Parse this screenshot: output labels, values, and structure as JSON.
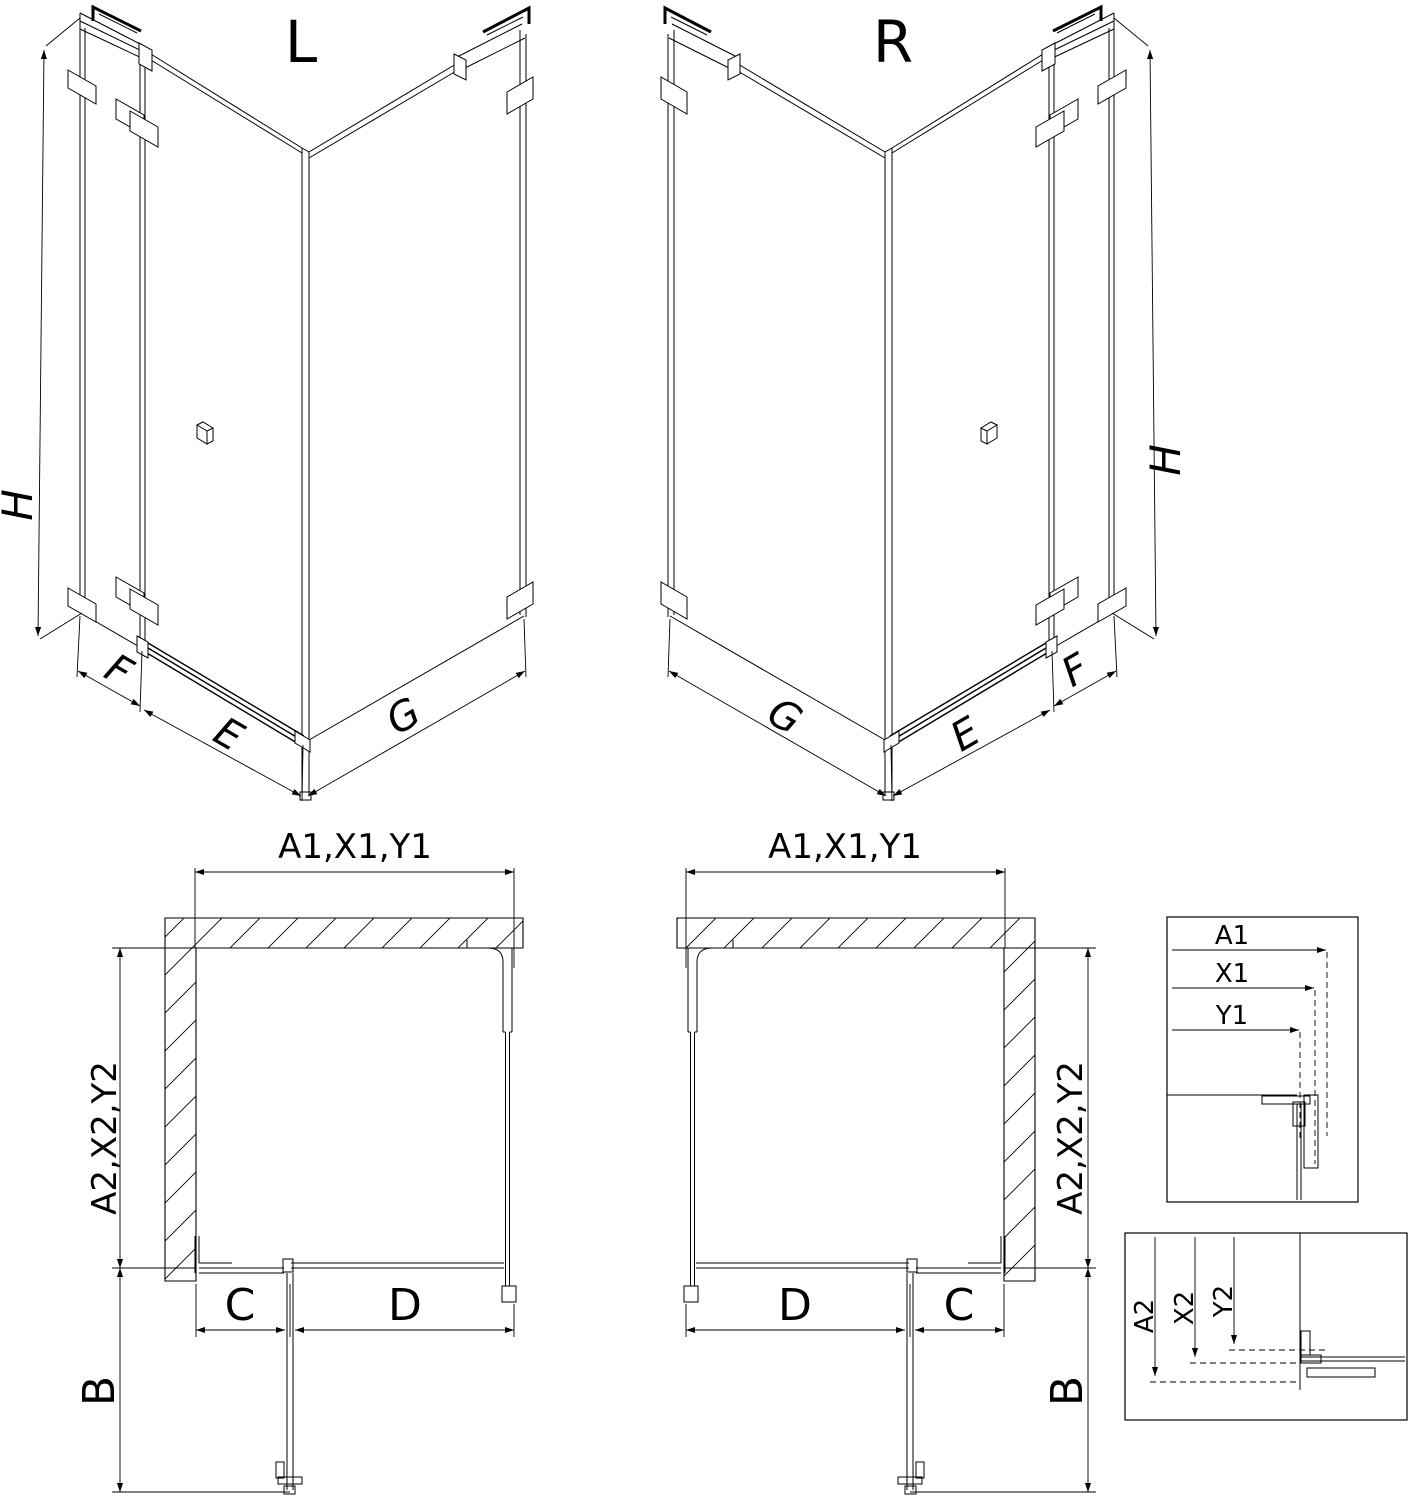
{
  "views": {
    "iso_left": {
      "title": "L",
      "dims": {
        "height": "H",
        "fixed_panel": "F",
        "door": "E",
        "side_panel": "G"
      }
    },
    "iso_right": {
      "title": "R",
      "dims": {
        "height": "H",
        "fixed_panel": "F",
        "door": "E",
        "side_panel": "G"
      }
    },
    "plan_left": {
      "dims": {
        "width": "A1,X1,Y1",
        "depth": "A2,X2,Y2",
        "door_swing": "B",
        "fixed_front": "C",
        "door_front": "D"
      }
    },
    "plan_right": {
      "dims": {
        "width": "A1,X1,Y1",
        "depth": "A2,X2,Y2",
        "door_swing": "B",
        "fixed_front": "C",
        "door_front": "D"
      }
    },
    "detail_width": {
      "labels": [
        "A1",
        "X1",
        "Y1"
      ]
    },
    "detail_depth": {
      "labels": [
        "A2",
        "X2",
        "Y2"
      ]
    }
  },
  "colors": {
    "line": "#000000",
    "background": "#ffffff"
  }
}
